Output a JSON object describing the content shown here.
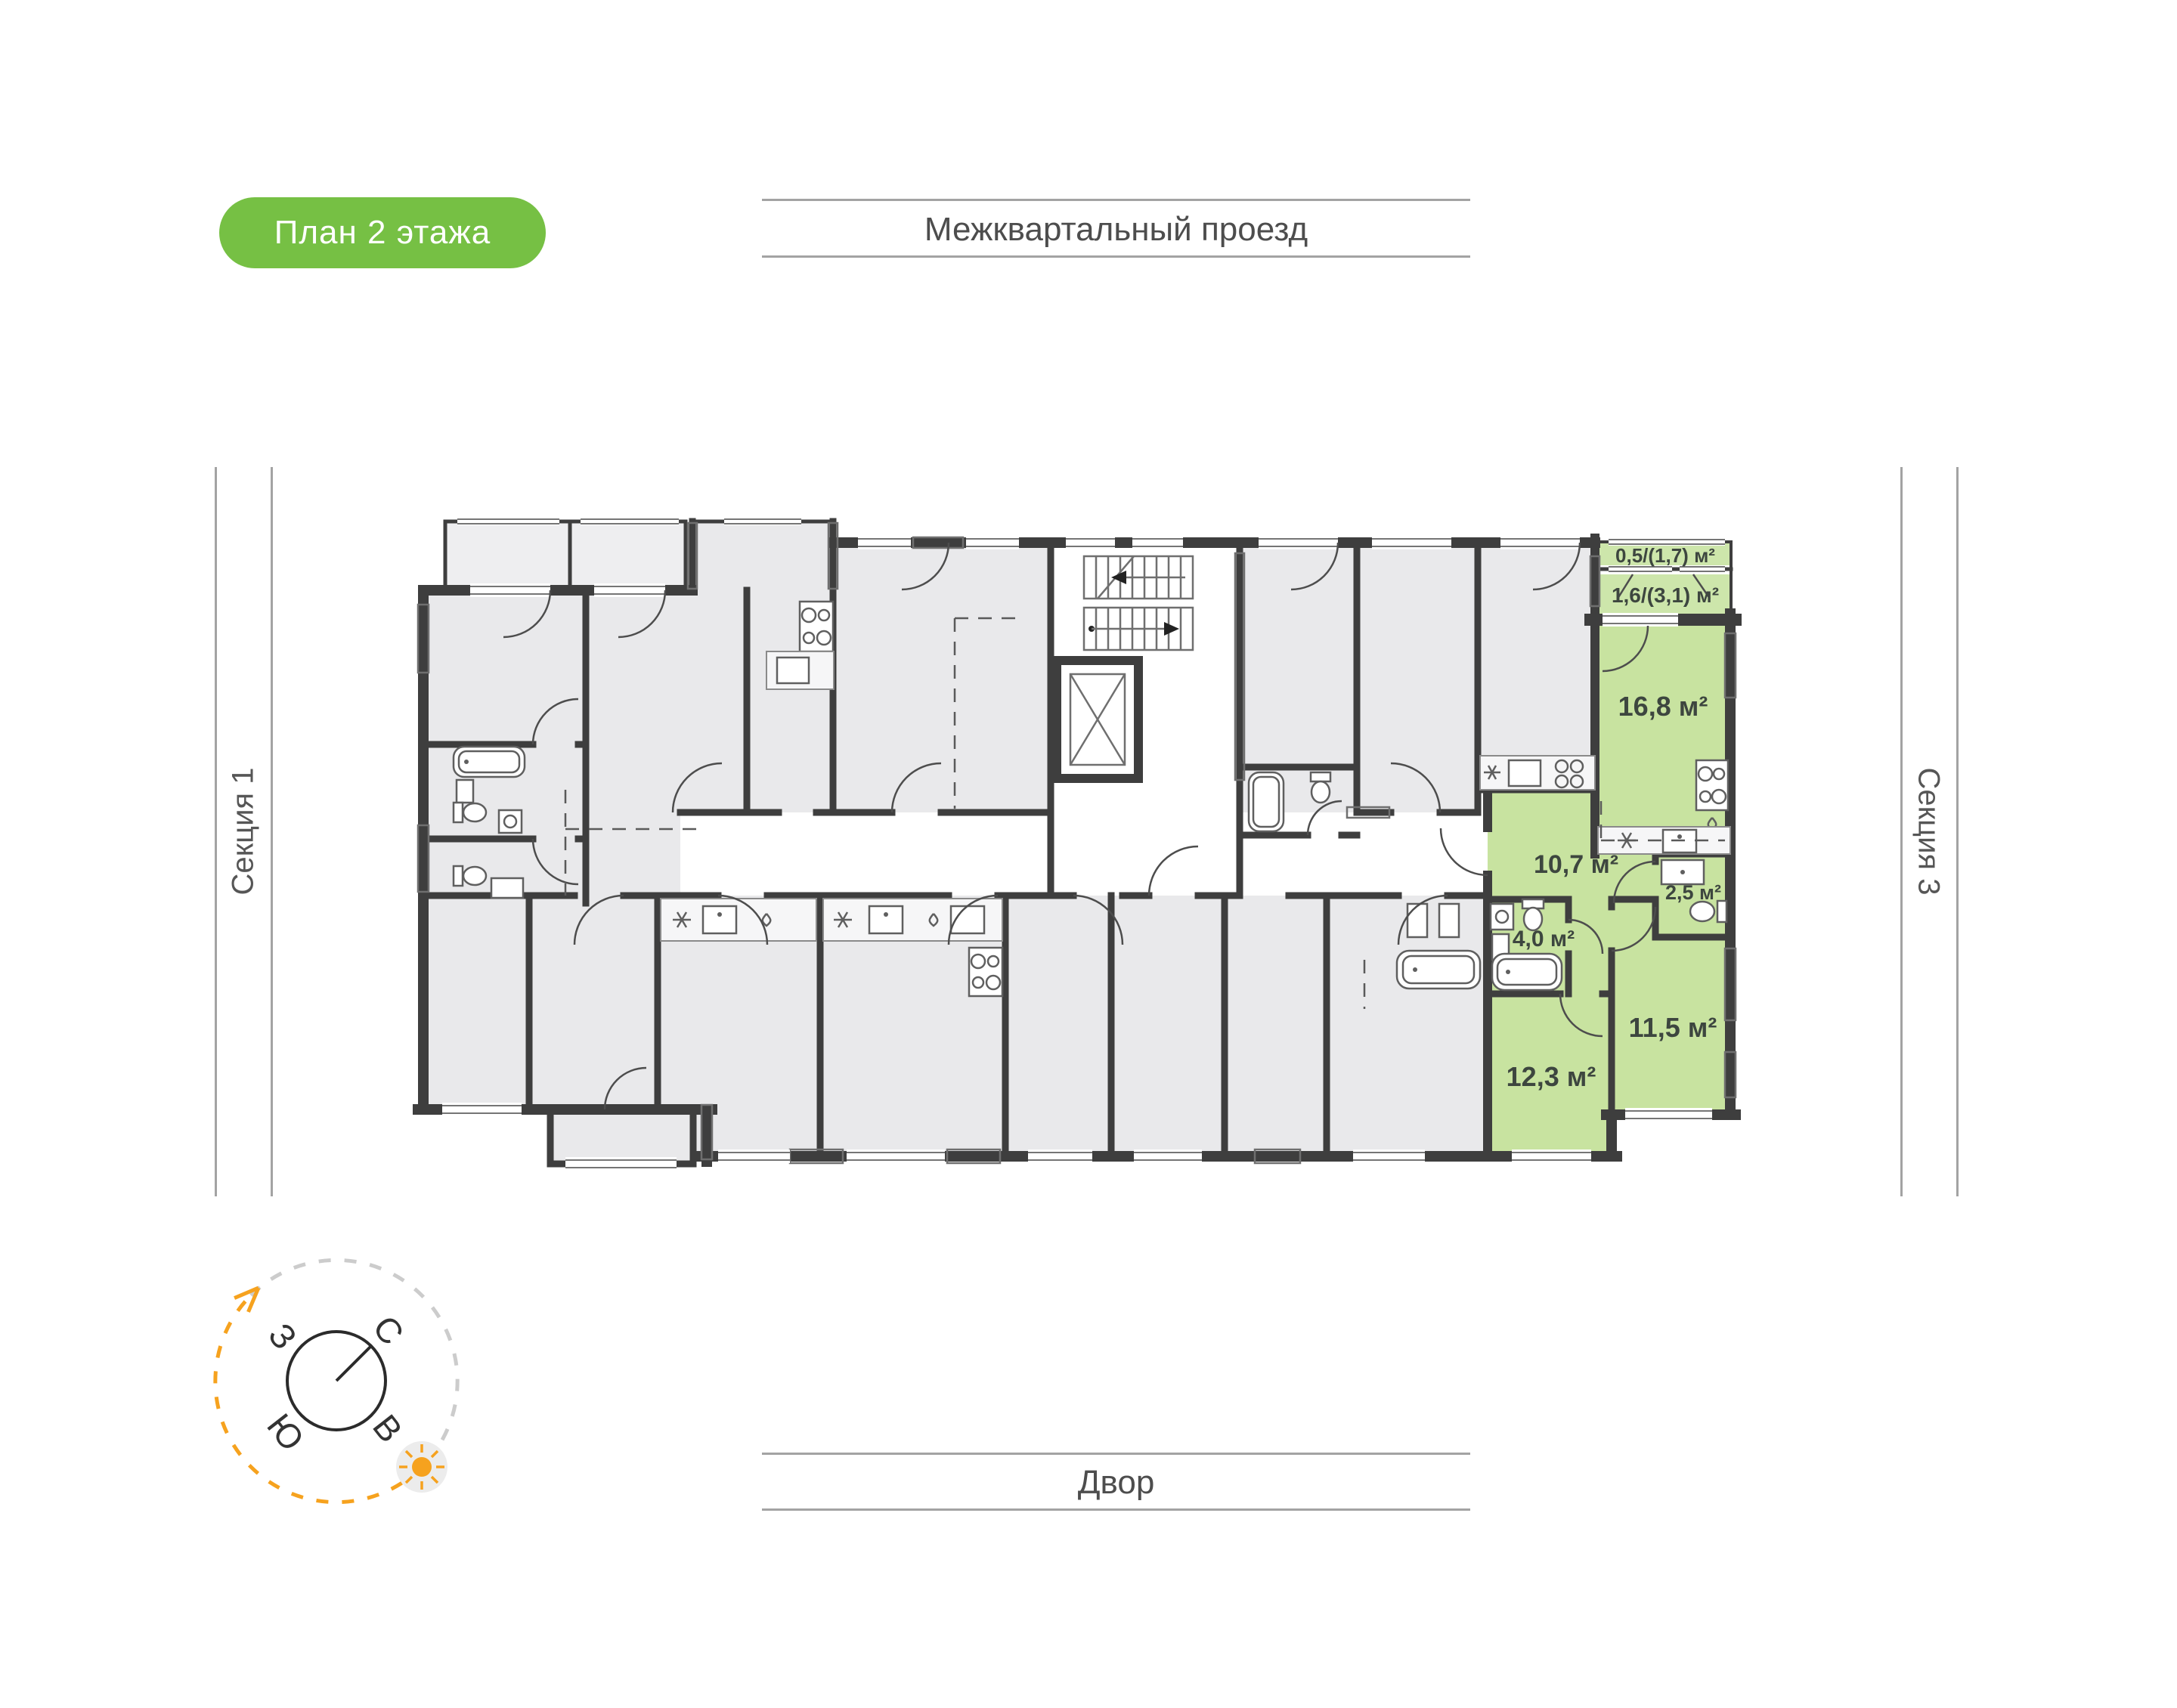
{
  "badge": {
    "label": "План 2 этажа",
    "bg_color": "#76c044",
    "text_color": "#ffffff"
  },
  "street": {
    "label": "Межквартальный проезд"
  },
  "yard": {
    "label": "Двор"
  },
  "sections": {
    "left": "Секция 1",
    "right": "Секция 3"
  },
  "compass": {
    "north": "С",
    "west": "З",
    "south": "Ю",
    "east": "В",
    "accent_color": "#f6a21e"
  },
  "plan": {
    "floor_title": "План 2 этажа",
    "highlight_color": "#c8e3a0",
    "room_fill": "#e9e9eb",
    "wall_color": "#3e3e3e",
    "rooms": [
      {
        "id": "balcony",
        "label": "0,5/(1,7) м²"
      },
      {
        "id": "loggia",
        "label": "1,6/(3,1) м²"
      },
      {
        "id": "kitchen-living",
        "label": "16,8 м²"
      },
      {
        "id": "hallway",
        "label": "10,7 м²"
      },
      {
        "id": "wc",
        "label": "2,5 м²"
      },
      {
        "id": "bathroom",
        "label": "4,0 м²"
      },
      {
        "id": "bedroom-1",
        "label": "12,3 м²"
      },
      {
        "id": "bedroom-2",
        "label": "11,5 м²"
      }
    ]
  }
}
